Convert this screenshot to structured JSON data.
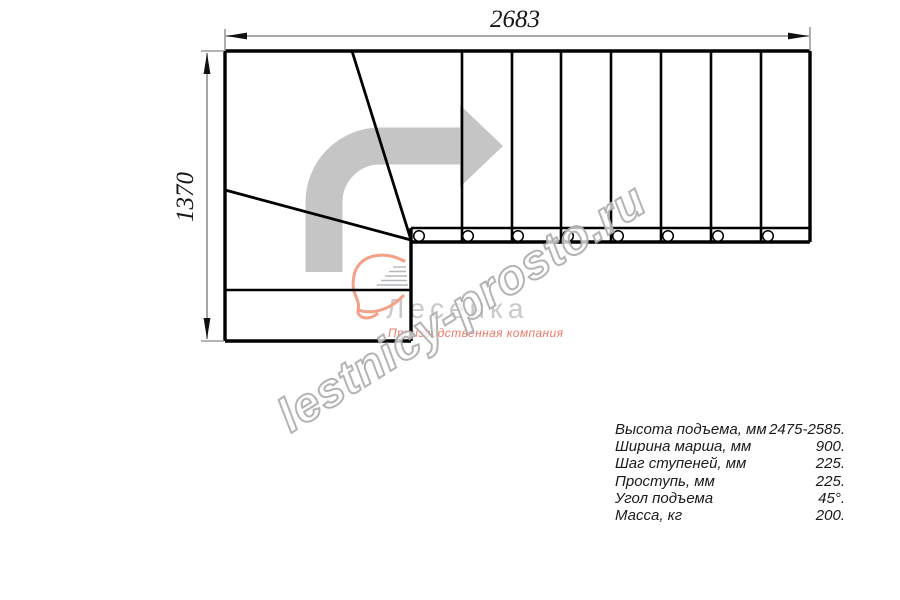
{
  "dimensions": {
    "width_mm": "2683",
    "depth_mm": "1370"
  },
  "watermark": {
    "text": "lestnicy-prosto.ru"
  },
  "logo": {
    "name": "Лесенка",
    "tagline": "Производственная компания"
  },
  "specs": {
    "rows": [
      {
        "label": "Высота подъема, мм",
        "value": "2475-2585."
      },
      {
        "label": "Ширина марша, мм",
        "value": "900."
      },
      {
        "label": "Шаг ступеней, мм",
        "value": "225."
      },
      {
        "label": "Проступь, мм",
        "value": "225."
      },
      {
        "label": "Угол подъема",
        "value": "45°."
      },
      {
        "label": "Масса, кг",
        "value": "200."
      }
    ]
  },
  "colors": {
    "plan_line": "#000000",
    "dimension_line": "#9b9b9b",
    "dimension_text": "#161616",
    "direction_arrow": "#c5c5c5",
    "watermark_outline": "#b0b0b0",
    "logo_gray": "#c9c9c9",
    "logo_accent": "#ee7966",
    "logo_swoosh": "#f4a188"
  }
}
